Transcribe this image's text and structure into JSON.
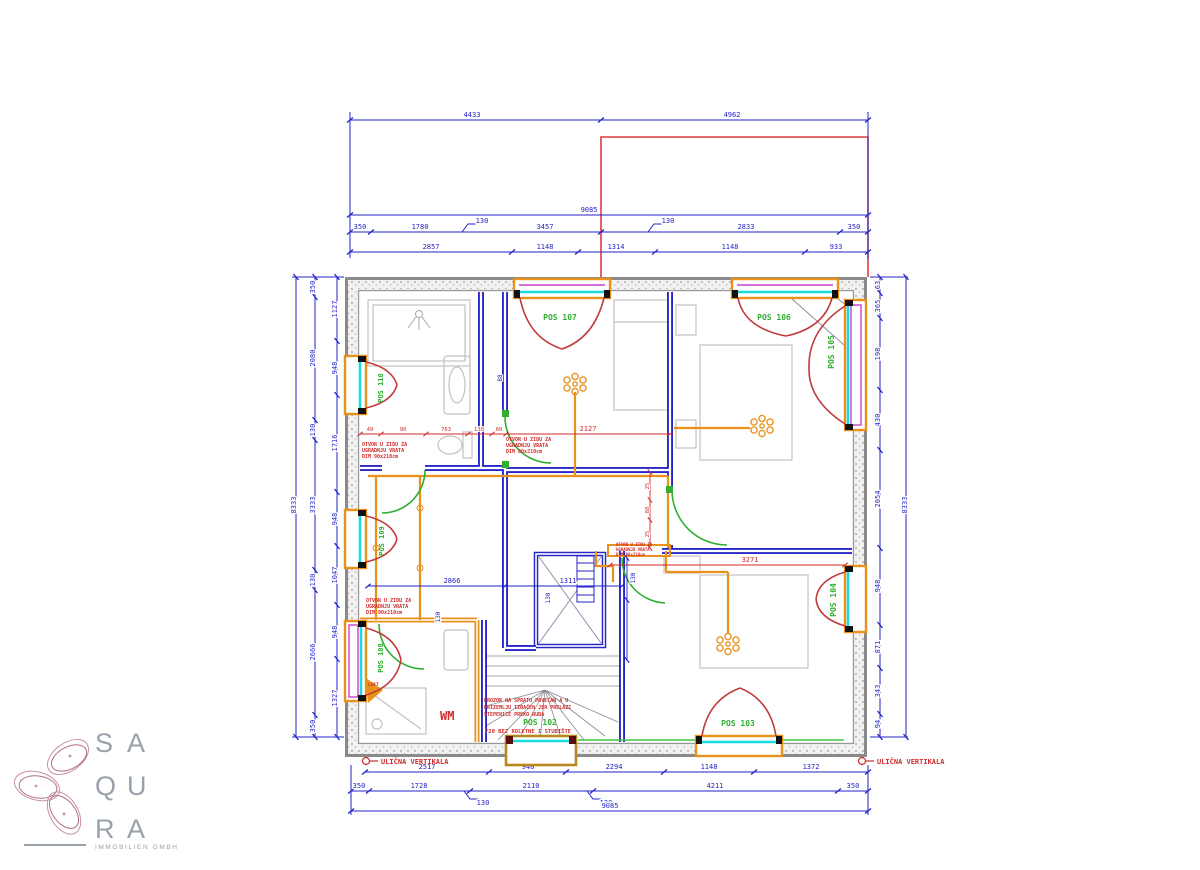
{
  "brand": {
    "letters": [
      "S",
      "A",
      "Q",
      "U",
      "R",
      "A"
    ],
    "subtitle": "IMMOBILIEN GMBH"
  },
  "labels": {
    "pos102": "POS 102",
    "pos103": "POS 103",
    "pos104": "POS 104",
    "pos105": "POS 105",
    "pos106": "POS 106",
    "pos107": "POS 107",
    "pos108": "POS 108",
    "pos109": "POS 109",
    "pos110": "POS 110",
    "wm": "WM",
    "luft": "LUFT",
    "ulicna_left": "ULIČNA VERTIKALA",
    "ulicna_right": "ULIČNA VERTIKALA"
  },
  "notes": {
    "door_a": [
      "OTVOR U ZIDU ZA",
      "UGRADNJU VRATA",
      "DIM 90x210cm"
    ],
    "door_b": [
      "OTVOR U ZIDU ZA",
      "UGRADNJU VRATA",
      "DIM 80x210cm"
    ],
    "door_c": [
      "OTVOR U ZIDU ZA",
      "UGRADNJU VRATA",
      "DIM 90x210cm"
    ],
    "door_d": [
      "OTVOR U ZIDU ZA",
      "UGRADNJU VRATA",
      "DIM 80x210cm"
    ],
    "stair": [
      "PROZOR NA SPRATU POVEĆAN A U",
      "PRIZEMLJU IZBAČEN JER PRELAZI",
      "STEPENICE PREKO RUBA"
    ],
    "stair_pos": "POS 102",
    "stair_f20": "F20 BEZ ROLETNE I STUBIŠTE"
  },
  "dims": {
    "top_total": [
      "4433",
      "4962"
    ],
    "top_overall": "9085",
    "top_chain": [
      "350",
      "1780",
      "130",
      "3457",
      "130",
      "2833",
      "350"
    ],
    "top_detail": [
      "2857",
      "1148",
      "1314",
      "1148",
      "933"
    ],
    "bot_detail": [
      "2517",
      "948",
      "2294",
      "1148",
      "1372"
    ],
    "bot_chain": [
      "350",
      "1728",
      "130",
      "2110",
      "130",
      "4211",
      "350"
    ],
    "bot_overall": "9085",
    "left_total": "8333",
    "left_chain": [
      "350",
      "2080",
      "130",
      "3333",
      "130",
      "2666",
      "350"
    ],
    "left_detail": [
      "1127",
      "948",
      "1716",
      "948",
      "1047",
      "948",
      "1327"
    ],
    "right_chain": [
      "63",
      "365",
      "198",
      "430",
      "2054",
      "948",
      "871",
      "343",
      "94"
    ],
    "right_total": "8333",
    "red_bath": [
      "49",
      "90",
      "763",
      "130",
      "60"
    ],
    "red_2127": "2127",
    "red_3271": "3271",
    "red_vert": [
      "25",
      "88",
      "25"
    ],
    "blue_mid": [
      "2866",
      "1311"
    ],
    "blue_small": [
      "130",
      "130",
      "130",
      "88"
    ]
  },
  "colors": {
    "dim_blue": "#2323c8",
    "wall_blue": "#2626c9",
    "red": "#d32a2a",
    "green": "#2fae2f",
    "orange": "#e8921c",
    "cyan": "#19dbe0",
    "magenta": "#cc3fcc",
    "logo_gray": "#99a2aa",
    "logo_pink": "#c9909e"
  }
}
